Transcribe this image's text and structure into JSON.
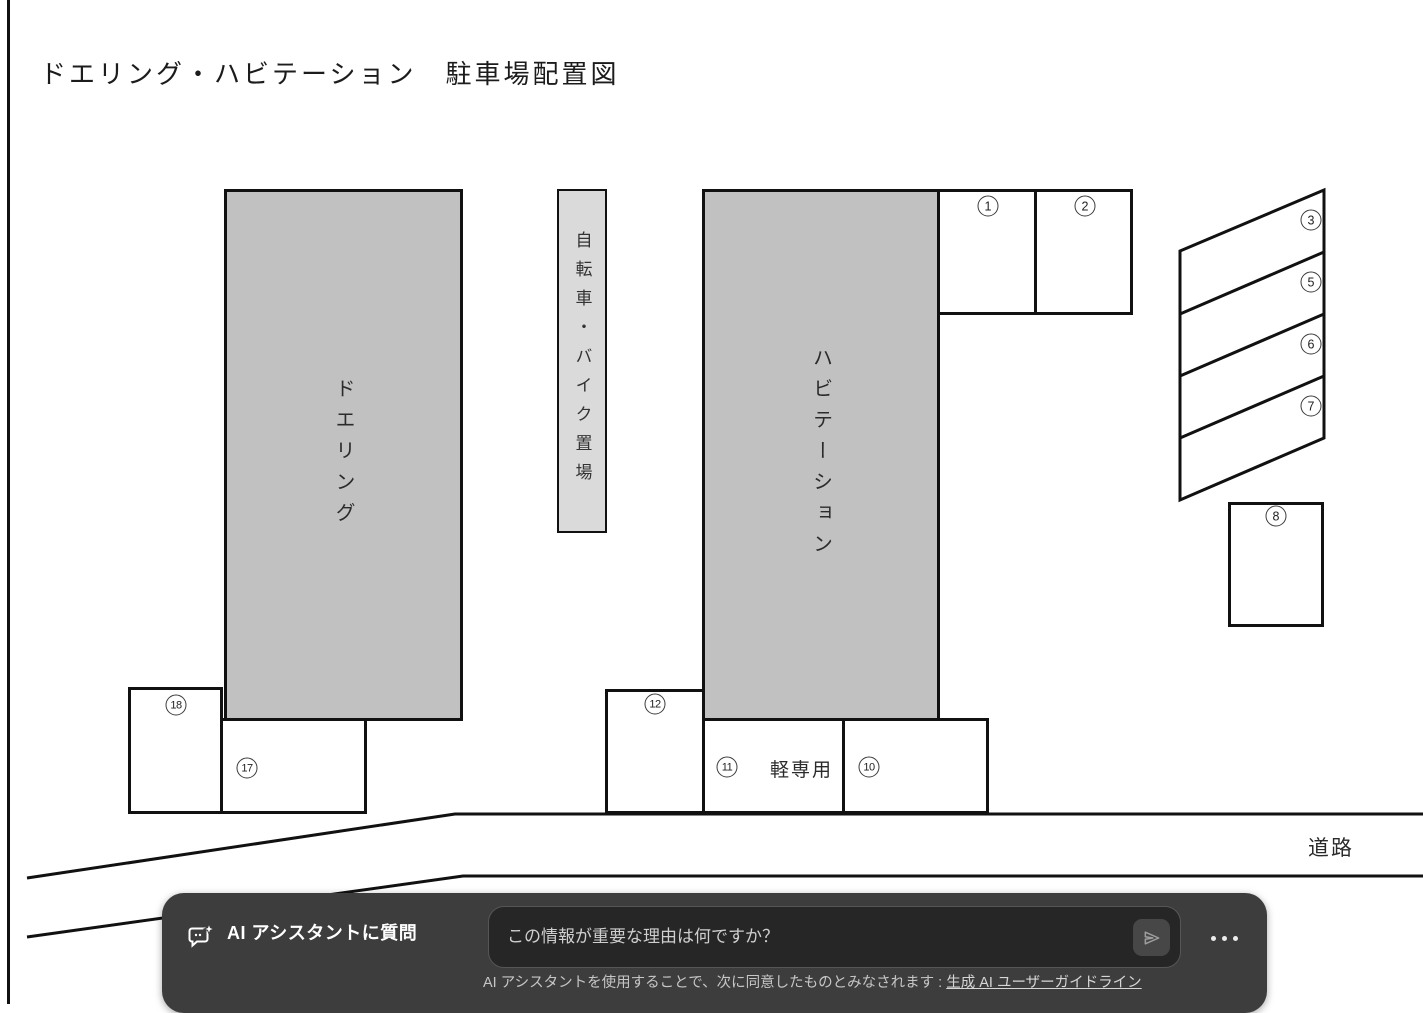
{
  "title": "ドエリング・ハビテーション　駐車場配置図",
  "diagram": {
    "building_left_label": "ドエリング",
    "building_right_label": "ハビテーション",
    "bike_area_label": "自転車・バイク置場",
    "kei_only_label": "軽専用",
    "road_label": "道路",
    "spaces": {
      "s1": "1",
      "s2": "2",
      "s3": "3",
      "s5": "5",
      "s6": "6",
      "s7": "7",
      "s8": "8",
      "s10": "10",
      "s11": "11",
      "s12": "12",
      "s17": "17",
      "s18": "18"
    }
  },
  "assistant": {
    "icon_name": "chat-sparkle-icon",
    "title": "AI アシスタントに質問",
    "input_placeholder": "この情報が重要な理由は何ですか？",
    "send_icon_name": "send-icon",
    "more_icon_name": "ellipsis-icon",
    "disclaimer_text": "AI アシスタントを使用することで、次に同意したものとみなされます : ",
    "guideline_link_label": "生成 AI ユーザーガイドライン"
  },
  "colors": {
    "building_fill": "#c1c1c1",
    "bike_area_fill": "#dadada",
    "line_color": "#111111",
    "assistant_bar_bg": "#3d3d3d",
    "assistant_input_bg": "#262626"
  }
}
